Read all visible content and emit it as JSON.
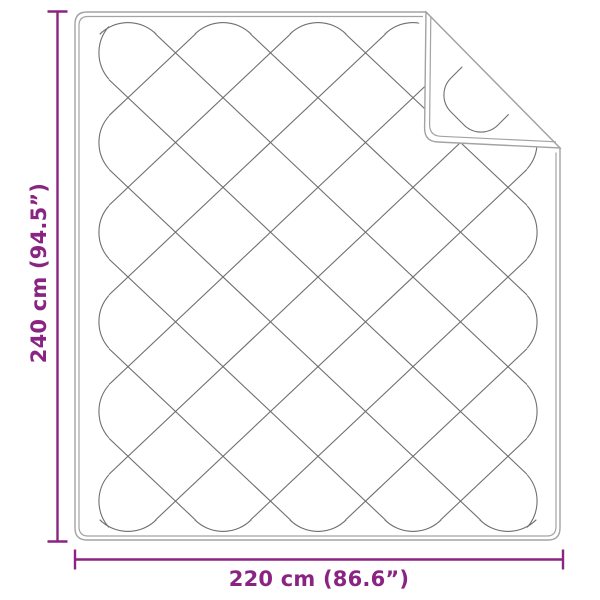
{
  "diagram": {
    "kind": "quilted-blanket-dimension-drawing",
    "height_label": "240 cm (94.5”)",
    "width_label": "220 cm (86.6”)",
    "height_cm": 240,
    "height_inches": 94.5,
    "width_cm": 220,
    "width_inches": 86.6,
    "colors": {
      "dimension_accent": "#8A2483",
      "blanket_outline": "#A3A3A3",
      "stitching": "#6F6F6F",
      "background": "#FFFFFF"
    }
  }
}
